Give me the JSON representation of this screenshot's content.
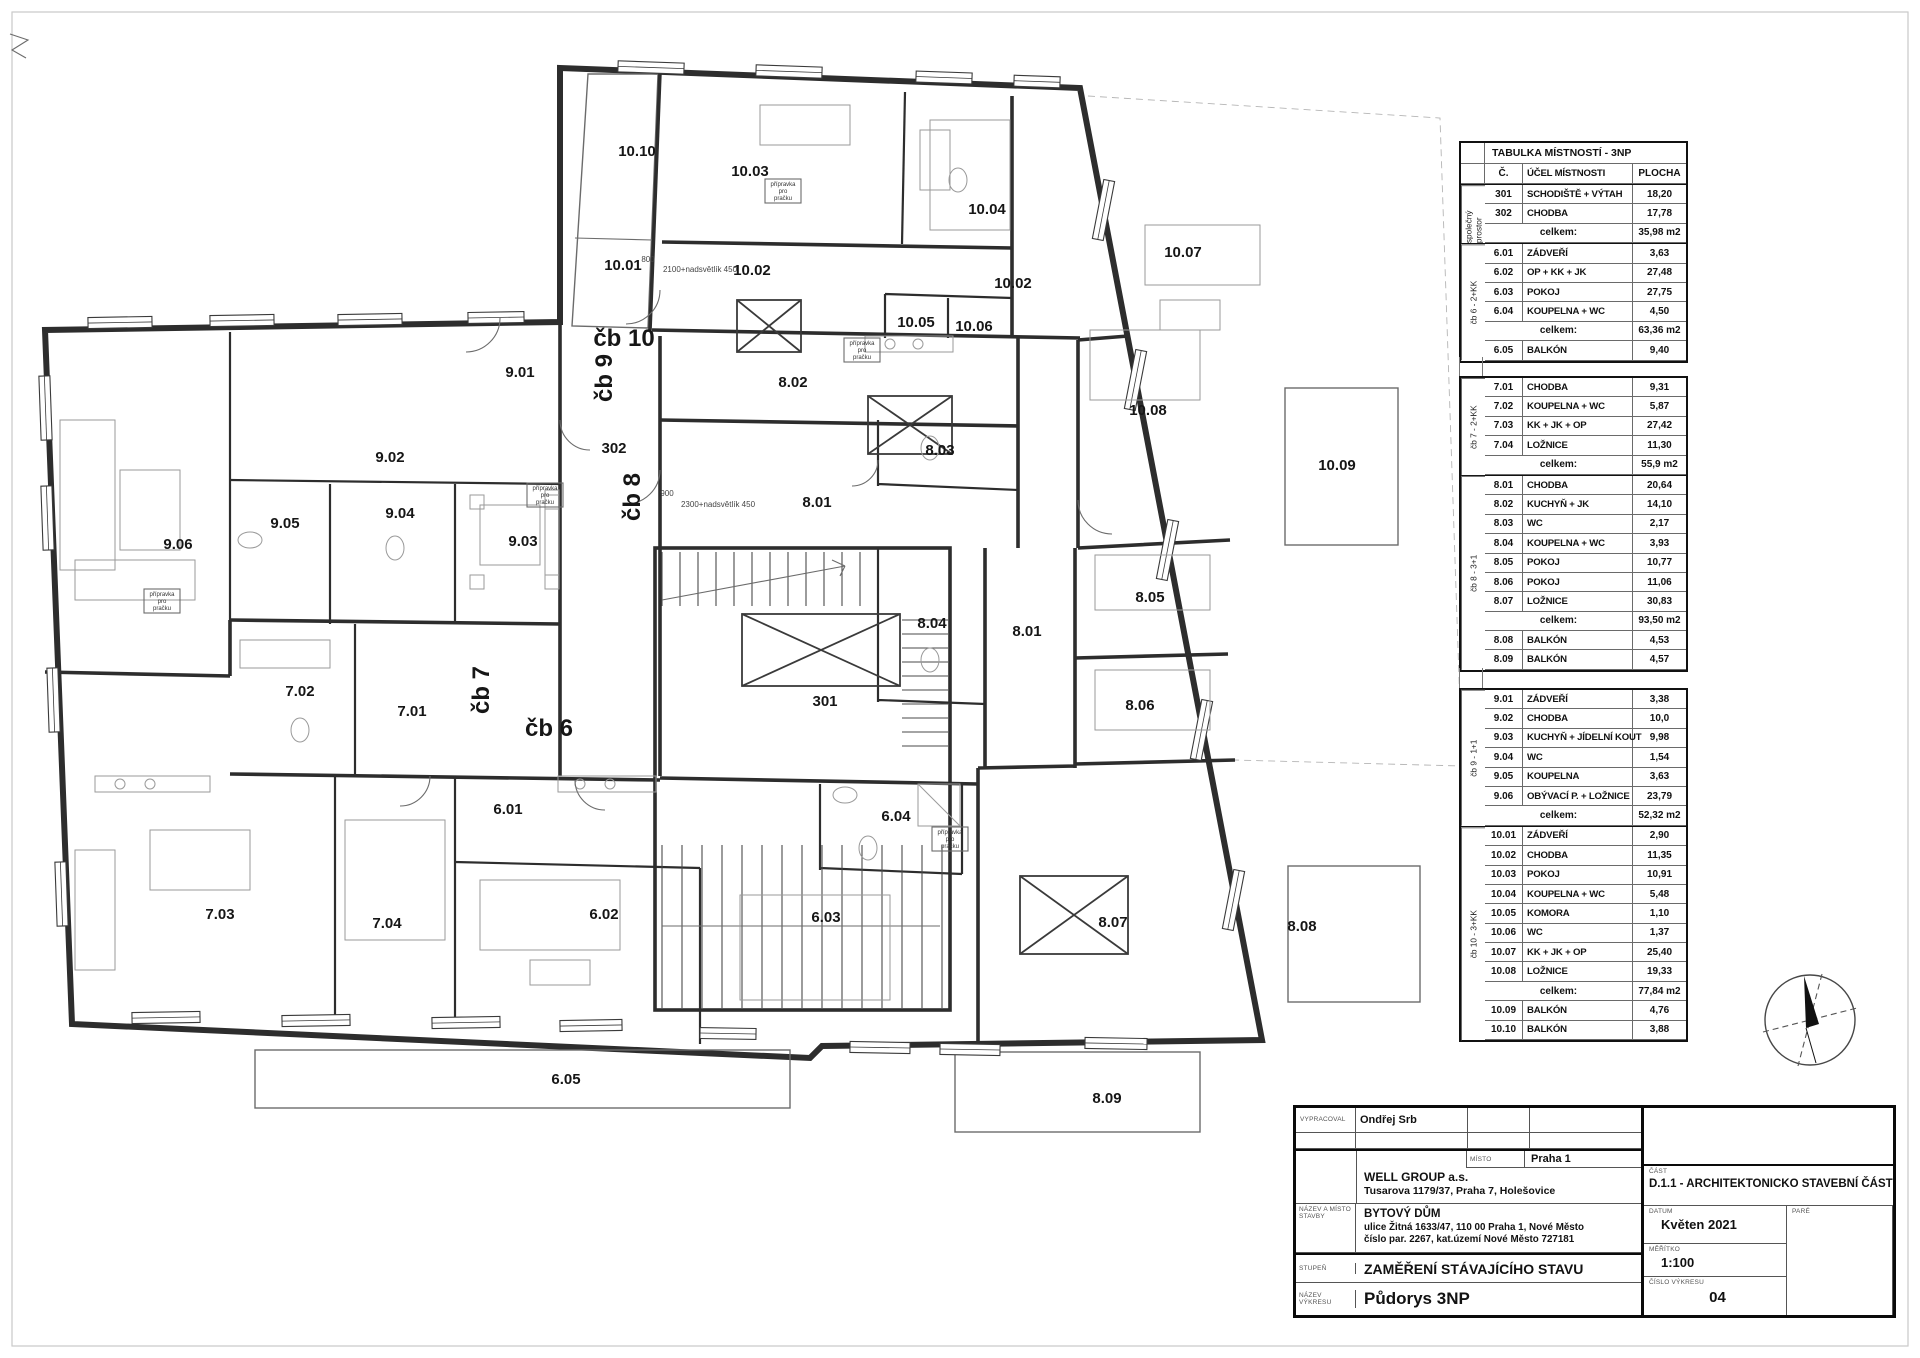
{
  "legend": {
    "title": "TABULKA MÍSTNOSTÍ - 3NP",
    "col_no": "Č.",
    "col_name": "ÚČEL MÍSTNOSTI",
    "col_area": "PLOCHA",
    "total_label": "celkem:",
    "blocks": [
      {
        "groups": [
          {
            "label": "společný prostor",
            "rows": [
              [
                "301",
                "SCHODIŠTĚ + VÝTAH",
                "18,20"
              ],
              [
                "302",
                "CHODBA",
                "17,78"
              ]
            ],
            "total": "35,98 m2",
            "extra": []
          },
          {
            "label": "čb 6 - 2+KK",
            "rows": [
              [
                "6.01",
                "ZÁDVEŘÍ",
                "3,63"
              ],
              [
                "6.02",
                "OP + KK + JK",
                "27,48"
              ],
              [
                "6.03",
                "POKOJ",
                "27,75"
              ],
              [
                "6.04",
                "KOUPELNA + WC",
                "4,50"
              ]
            ],
            "total": "63,36 m2",
            "extra": [
              [
                "6.05",
                "BALKÓN",
                "9,40"
              ]
            ]
          }
        ]
      },
      {
        "groups": [
          {
            "label": "čb 7 - 2+KK",
            "rows": [
              [
                "7.01",
                "CHODBA",
                "9,31"
              ],
              [
                "7.02",
                "KOUPELNA + WC",
                "5,87"
              ],
              [
                "7.03",
                "KK + JK + OP",
                "27,42"
              ],
              [
                "7.04",
                "LOŽNICE",
                "11,30"
              ]
            ],
            "total": "55,9 m2",
            "extra": []
          },
          {
            "label": "čb 8 - 3+1",
            "rows": [
              [
                "8.01",
                "CHODBA",
                "20,64"
              ],
              [
                "8.02",
                "KUCHYŇ + JK",
                "14,10"
              ],
              [
                "8.03",
                "WC",
                "2,17"
              ],
              [
                "8.04",
                "KOUPELNA + WC",
                "3,93"
              ],
              [
                "8.05",
                "POKOJ",
                "10,77"
              ],
              [
                "8.06",
                "POKOJ",
                "11,06"
              ],
              [
                "8.07",
                "LOŽNICE",
                "30,83"
              ]
            ],
            "total": "93,50 m2",
            "extra": [
              [
                "8.08",
                "BALKÓN",
                "4,53"
              ],
              [
                "8.09",
                "BALKÓN",
                "4,57"
              ]
            ]
          }
        ]
      },
      {
        "groups": [
          {
            "label": "čb 9 - 1+1",
            "rows": [
              [
                "9.01",
                "ZÁDVEŘÍ",
                "3,38"
              ],
              [
                "9.02",
                "CHODBA",
                "10,0"
              ],
              [
                "9.03",
                "KUCHYŇ + JÍDELNÍ KOUT",
                "9,98"
              ],
              [
                "9.04",
                "WC",
                "1,54"
              ],
              [
                "9.05",
                "KOUPELNA",
                "3,63"
              ],
              [
                "9.06",
                "OBÝVACÍ P. + LOŽNICE",
                "23,79"
              ]
            ],
            "total": "52,32 m2",
            "extra": []
          },
          {
            "label": "čb 10 - 3+KK",
            "rows": [
              [
                "10.01",
                "ZÁDVEŘÍ",
                "2,90"
              ],
              [
                "10.02",
                "CHODBA",
                "11,35"
              ],
              [
                "10.03",
                "POKOJ",
                "10,91"
              ],
              [
                "10.04",
                "KOUPELNA + WC",
                "5,48"
              ],
              [
                "10.05",
                "KOMORA",
                "1,10"
              ],
              [
                "10.06",
                "WC",
                "1,37"
              ],
              [
                "10.07",
                "KK + JK + OP",
                "25,40"
              ],
              [
                "10.08",
                "LOŽNICE",
                "19,33"
              ]
            ],
            "total": "77,84 m2",
            "extra": [
              [
                "10.09",
                "BALKÓN",
                "4,76"
              ],
              [
                "10.10",
                "BALKÓN",
                "3,88"
              ]
            ]
          }
        ]
      }
    ]
  },
  "plan": {
    "labels": [
      {
        "text": "10.10",
        "x": 637,
        "y": 156
      },
      {
        "text": "10.03",
        "x": 750,
        "y": 176
      },
      {
        "text": "10.04",
        "x": 987,
        "y": 214
      },
      {
        "text": "10.07",
        "x": 1183,
        "y": 257
      },
      {
        "text": "10.01",
        "x": 623,
        "y": 270
      },
      {
        "text": "10.02",
        "x": 752,
        "y": 275
      },
      {
        "text": "10.02",
        "x": 1013,
        "y": 288
      },
      {
        "text": "10.05",
        "x": 916,
        "y": 327
      },
      {
        "text": "10.06",
        "x": 974,
        "y": 331
      },
      {
        "text": "čb 10",
        "x": 624,
        "y": 346,
        "big": true
      },
      {
        "text": "čb 9",
        "x": 612,
        "y": 378,
        "big": true,
        "rot": -90
      },
      {
        "text": "9.01",
        "x": 520,
        "y": 377
      },
      {
        "text": "8.02",
        "x": 793,
        "y": 387
      },
      {
        "text": "10.08",
        "x": 1148,
        "y": 415
      },
      {
        "text": "302",
        "x": 614,
        "y": 453
      },
      {
        "text": "8.03",
        "x": 940,
        "y": 455
      },
      {
        "text": "9.02",
        "x": 390,
        "y": 462
      },
      {
        "text": "10.09",
        "x": 1337,
        "y": 470
      },
      {
        "text": "čb 8",
        "x": 640,
        "y": 497,
        "big": true,
        "rot": -90
      },
      {
        "text": "8.01",
        "x": 817,
        "y": 507
      },
      {
        "text": "9.04",
        "x": 400,
        "y": 518
      },
      {
        "text": "9.05",
        "x": 285,
        "y": 528
      },
      {
        "text": "9.03",
        "x": 523,
        "y": 546
      },
      {
        "text": "9.06",
        "x": 178,
        "y": 549
      },
      {
        "text": "8.05",
        "x": 1150,
        "y": 602
      },
      {
        "text": "8.04",
        "x": 932,
        "y": 628
      },
      {
        "text": "8.01",
        "x": 1027,
        "y": 636
      },
      {
        "text": "čb 7",
        "x": 489,
        "y": 690,
        "big": true,
        "rot": -90
      },
      {
        "text": "7.02",
        "x": 300,
        "y": 696
      },
      {
        "text": "301",
        "x": 825,
        "y": 706
      },
      {
        "text": "8.06",
        "x": 1140,
        "y": 710
      },
      {
        "text": "7.01",
        "x": 412,
        "y": 716
      },
      {
        "text": "čb 6",
        "x": 549,
        "y": 736,
        "big": true
      },
      {
        "text": "6.01",
        "x": 508,
        "y": 814
      },
      {
        "text": "6.04",
        "x": 896,
        "y": 821
      },
      {
        "text": "7.03",
        "x": 220,
        "y": 919
      },
      {
        "text": "6.02",
        "x": 604,
        "y": 919
      },
      {
        "text": "6.03",
        "x": 826,
        "y": 922
      },
      {
        "text": "7.04",
        "x": 387,
        "y": 928
      },
      {
        "text": "8.07",
        "x": 1113,
        "y": 927
      },
      {
        "text": "8.08",
        "x": 1302,
        "y": 931
      },
      {
        "text": "6.05",
        "x": 566,
        "y": 1084
      },
      {
        "text": "8.09",
        "x": 1107,
        "y": 1103
      }
    ],
    "annotations": [
      {
        "text": "800",
        "x": 648,
        "y": 262
      },
      {
        "text": "2100+nadsvětlík  450",
        "x": 700,
        "y": 272
      },
      {
        "text": "900",
        "x": 667,
        "y": 496
      },
      {
        "text": "2300+nadsvětlík  450",
        "x": 718,
        "y": 507
      }
    ],
    "prep_text_lines": [
      "přípravka",
      "pro",
      "pračku"
    ],
    "prep_boxes": [
      {
        "x": 783,
        "y": 190
      },
      {
        "x": 862,
        "y": 349
      },
      {
        "x": 162,
        "y": 600
      },
      {
        "x": 545,
        "y": 494
      },
      {
        "x": 950,
        "y": 838
      }
    ]
  },
  "title_block": {
    "vypracoval_label": "VYPRACOVAL",
    "vypracoval": "Ondřej Srb",
    "misto_label": "MÍSTO",
    "misto": "Praha 1",
    "investor_name": "WELL GROUP a.s.",
    "investor_addr": "Tusarova 1179/37, Praha 7, Holešovice",
    "stavba_label": "NÁZEV A MÍSTO STAVBY",
    "stavba_l1": "BYTOVÝ DŮM",
    "stavba_l2": "ulice Žitná 1633/47, 110 00  Praha 1, Nové Město",
    "stavba_l3": "číslo par. 2267, kat.území Nové Město 727181",
    "stupen_label": "STUPEŇ",
    "stupen": "ZAMĚŘENÍ STÁVAJÍCÍHO STAVU",
    "vykres_label": "NÁZEV VÝKRESU",
    "vykres": "Půdorys 3NP",
    "cast_label": "ČÁST",
    "cast": "D.1.1 - ARCHITEKTONICKO STAVEBNÍ ČÁST",
    "datum_label": "DATUM",
    "datum": "Květen 2021",
    "pare_label": "PARÉ",
    "meritko_label": "MĚŘÍTKO",
    "meritko": "1:100",
    "cislo_label": "ČÍSLO VÝKRESU",
    "cislo": "04"
  }
}
